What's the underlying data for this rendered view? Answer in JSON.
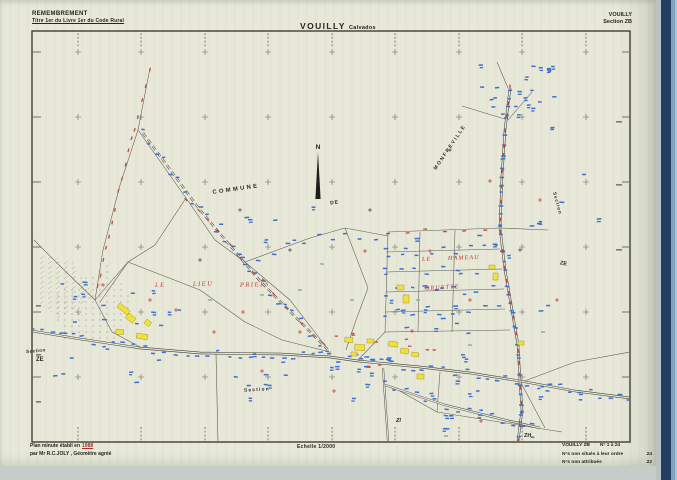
{
  "header": {
    "program": "REMEMBREMENT",
    "subtitle": "Titre 1er du Livre 1er du Code Rural",
    "commune": "VOUILLY",
    "departement": "Calvados",
    "sheet_commune": "VOUILLY",
    "sheet_section": "Section ZB"
  },
  "map": {
    "north_label": "N",
    "labels": {
      "commune_word": "COMMUNE",
      "de_word": "DE",
      "neighbor_commune": "MONFREVILLE",
      "left_section_word": "Section",
      "left_section_code": "ZE",
      "right_section_word": "Section",
      "right_section_code": "ZE",
      "bottom_section_word": "Section",
      "code_zi": "ZI",
      "code_zh": "ZH",
      "lieudit_1": "LE",
      "lieudit_2": "LIEU",
      "lieudit_3": "PRIELS",
      "hameau_1": "LE",
      "hameau_2": "HAMEAU",
      "hameau_3": "GRUETTE"
    }
  },
  "footer": {
    "plan_prefix": "Plan minute établi en",
    "plan_year": "1988",
    "plan_author": "par Mr R.C.JOLY , Géomètre agréé",
    "scale_label": "Echelle 1/2000",
    "sheet_ref": "VOUILLY ZB",
    "sheet_numbers": "N° 1 à 24",
    "not_located_label": "N°s non situés à leur ordre",
    "not_located_value": "24",
    "not_assigned_label": "N°s non attribués",
    "not_assigned_value": "22"
  },
  "colors": {
    "paper": "#e7e8d8",
    "frame_ink": "#3f3e36",
    "parcel_line": "#4b4a40",
    "tick_blue": "#3d6fd0",
    "tick_red": "#c5463a",
    "building_yellow": "#f0e13a",
    "lieudit_red": "#c13a2e",
    "band_navy": "#223f63"
  }
}
